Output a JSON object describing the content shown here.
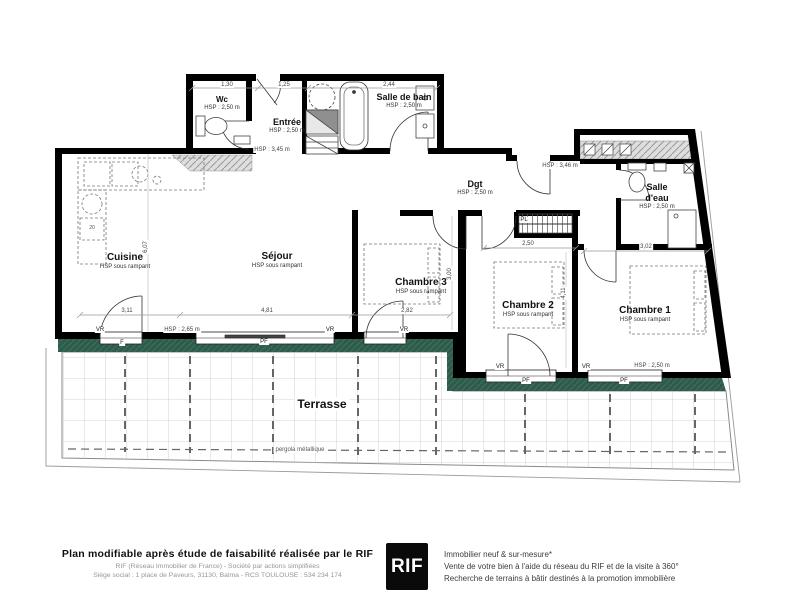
{
  "plan": {
    "rooms": {
      "wc": {
        "name": "Wc",
        "hsp": "HSP : 2,50 m"
      },
      "entree": {
        "name": "Entrée",
        "hsp": "HSP : 2,50 m"
      },
      "salle_de_bain": {
        "name": "Salle de bain",
        "hsp": "HSP : 2,50 m"
      },
      "dgt": {
        "name": "Dgt",
        "hsp": "HSP : 2,50 m"
      },
      "salle_deau": {
        "name": "Salle d'eau",
        "hsp": "HSP : 2,50 m"
      },
      "cuisine": {
        "name": "Cuisine",
        "hsp": "HSP sous rampant"
      },
      "sejour": {
        "name": "Séjour",
        "hsp": "HSP sous rampant"
      },
      "chambre3": {
        "name": "Chambre 3",
        "hsp": "HSP sous rampant"
      },
      "chambre2": {
        "name": "Chambre 2",
        "hsp": "HSP sous rampant"
      },
      "chambre1": {
        "name": "Chambre 1",
        "hsp": "HSP sous rampant"
      },
      "terrasse": {
        "name": "Terrasse",
        "note": "pergola métallique"
      }
    },
    "height_labels": {
      "entree_closet": "HSP : 3,45 m",
      "dgt_area": "HSP : 3,46 m",
      "sejour_bottom": "HSP : 2,65 m",
      "chambre1_bottom": "HSP : 2,50 m"
    },
    "dimensions": {
      "wc_width": "1,30",
      "entree_width": "1,25",
      "bain_width": "2,44",
      "cuisine_width": "3,11",
      "sejour_width": "4,81",
      "chambre3_width": "2,82",
      "chambre2_width": "2,50",
      "chambre1_width": "3,02",
      "sejour_depth": "6,07",
      "chambre3_depth": "3,00",
      "chambre2_depth": "4,11"
    },
    "openings": {
      "closet": "PL",
      "shutter": "VR",
      "french_window": "PF",
      "window": "F"
    },
    "kitchen_note": "20"
  },
  "footer": {
    "title": "Plan modifiable après étude de faisabilité réalisée par le RIF",
    "company_line": "RIF (Réseau Immobilier de France) - Société par actions simplifiées",
    "address_line": "Siège social : 1 place de Paveurs, 31130, Balma - RCS TOULOUSE : 534 234 174",
    "logo": "RIF",
    "services": [
      "Immobilier neuf & sur-mesure*",
      "Vente de votre bien à l'aide du réseau du RIF et de la visite à 360°",
      "Recherche de terrains à bâtir destinés à la promotion immobilière"
    ]
  },
  "colors": {
    "wall": "#000000",
    "terrace_green": "#2e5b4a",
    "hatch_gray": "#d9d9d9"
  }
}
